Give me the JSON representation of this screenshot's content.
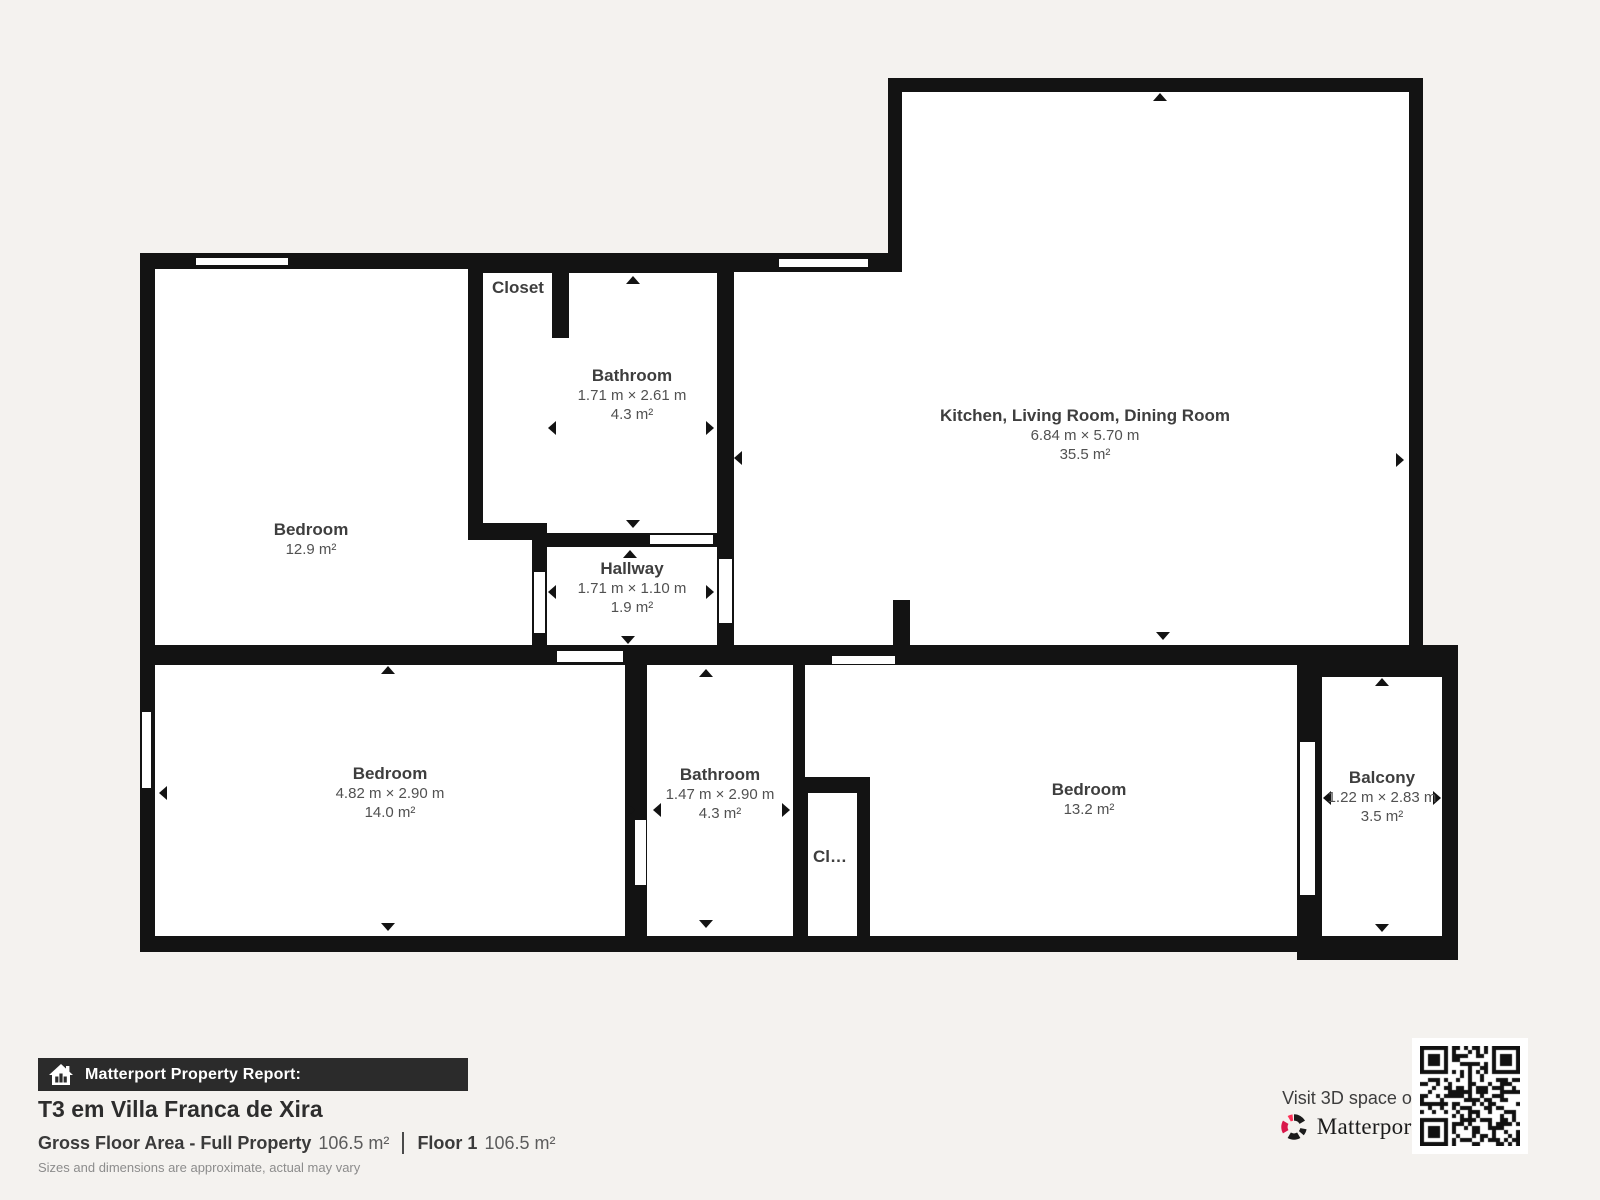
{
  "plan": {
    "rooms": [
      {
        "name": "kitchen-living-dining",
        "title": "Kitchen, Living Room, Dining Room",
        "dims": "6.84 m × 5.70 m",
        "area": "35.5 m²"
      },
      {
        "name": "bedroom-top-left",
        "title": "Bedroom",
        "area": "12.9 m²"
      },
      {
        "name": "closet-top",
        "title": "Closet"
      },
      {
        "name": "bathroom-top",
        "title": "Bathroom",
        "dims": "1.71 m × 2.61 m",
        "area": "4.3 m²"
      },
      {
        "name": "hallway",
        "title": "Hallway",
        "dims": "1.71 m × 1.10 m",
        "area": "1.9 m²"
      },
      {
        "name": "bedroom-bottom-left",
        "title": "Bedroom",
        "dims": "4.82 m × 2.90 m",
        "area": "14.0 m²"
      },
      {
        "name": "bathroom-bottom",
        "title": "Bathroom",
        "dims": "1.47 m × 2.90 m",
        "area": "4.3 m²"
      },
      {
        "name": "closet-small",
        "title": "Cl…"
      },
      {
        "name": "bedroom-bottom-right",
        "title": "Bedroom",
        "area": "13.2 m²"
      },
      {
        "name": "balcony",
        "title": "Balcony",
        "dims": "1.22 m × 2.83 m",
        "area": "3.5 m²"
      }
    ]
  },
  "footer": {
    "report_label": "Matterport Property Report:",
    "property_title": "T3 em Villa Franca de Xira",
    "gfa_label": "Gross Floor Area - Full Property",
    "gfa_value": "106.5 m²",
    "floor_label": "Floor 1",
    "floor_value": "106.5 m²",
    "disclaimer": "Sizes and dimensions are approximate, actual may vary",
    "visit_text": "Visit 3D space on",
    "brand": "Matterport",
    "brand_mark": "®"
  },
  "colors": {
    "wall": "#131313",
    "background": "#f4f2ef",
    "footer_bar": "#2b2b2b",
    "matterport_pink": "#ff3158",
    "matterport_red": "#d9184b"
  }
}
